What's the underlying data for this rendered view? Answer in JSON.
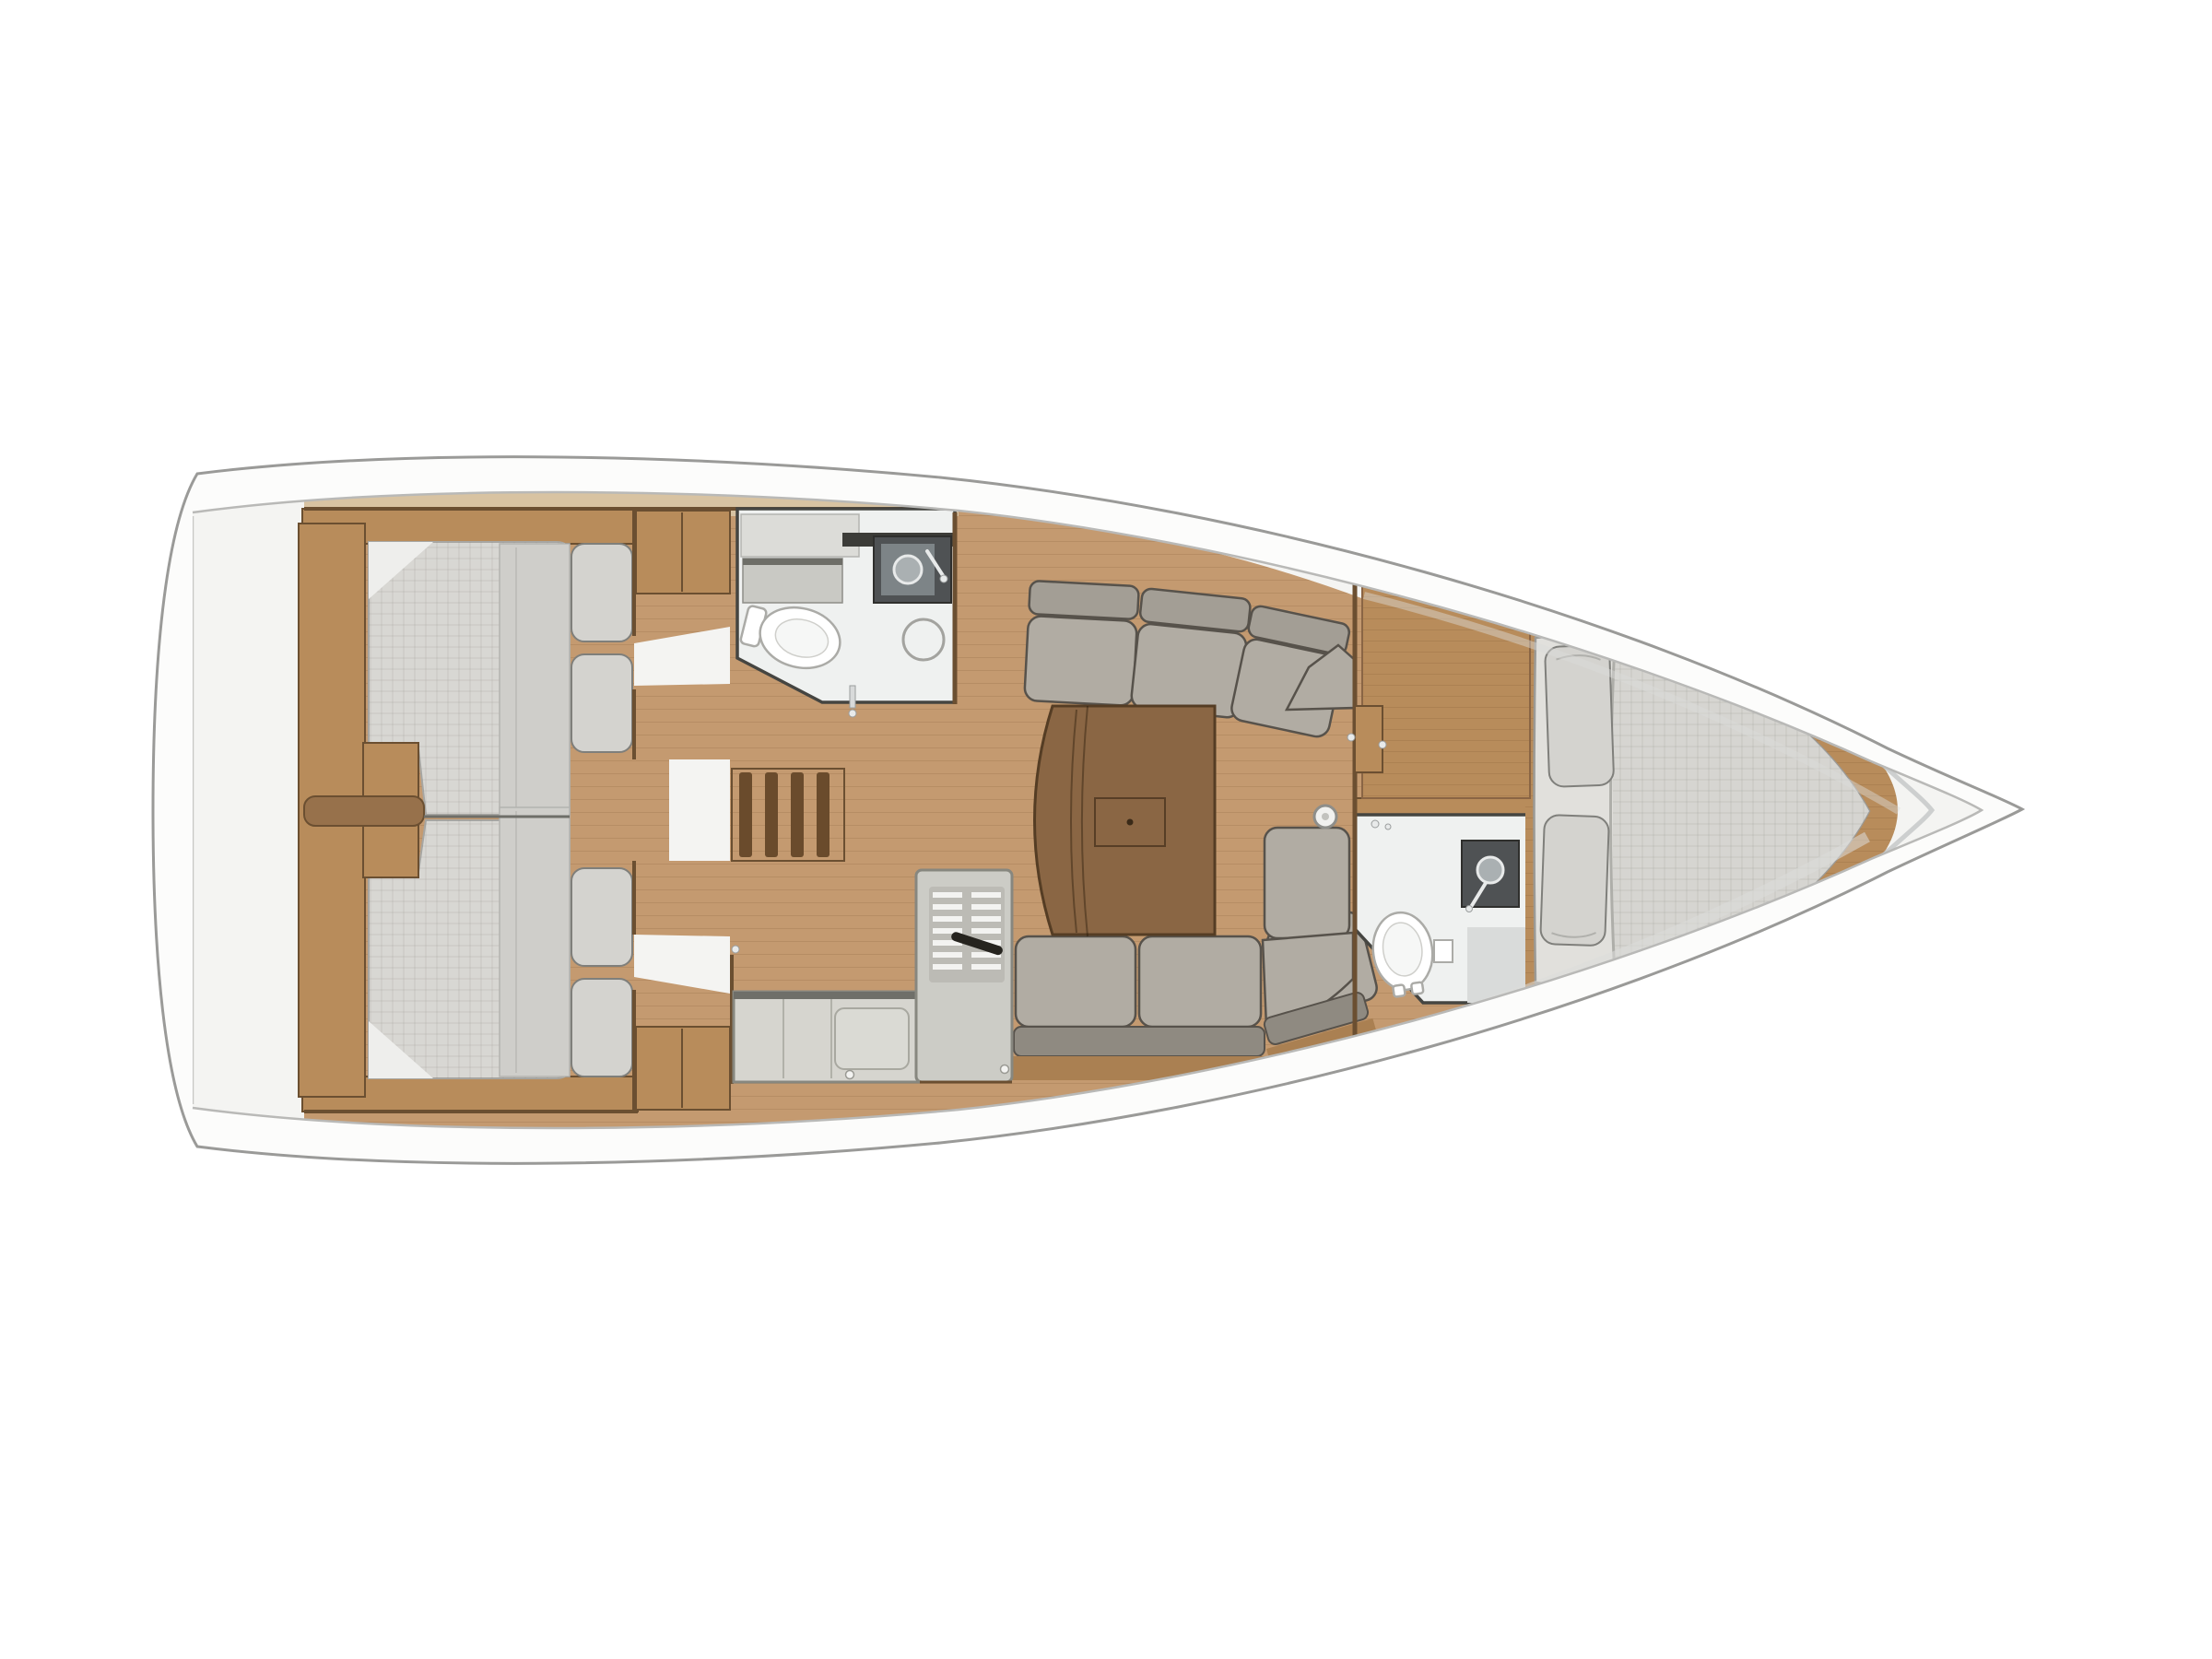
{
  "palette": {
    "page-bg": "#ffffff",
    "hull-fill": "#fcfcfb",
    "hull-stroke": "#9a9a98",
    "deck-line": "#b9b9b7",
    "shadow-line": "#dcdcda",
    "wood-floor": "#c49a70",
    "plank-seam": "rgba(110,74,40,0.16)",
    "wood-deck-band": "#d8c3a2",
    "wood-cabinet": "#b88c5b",
    "wood-cabinet-top": "#d5ae7c",
    "wood-dark": "#6b4f31",
    "wood-divider": "#97714b",
    "wood-rim": "#aa8052",
    "stair-slat": "#6a4b2c",
    "table-fill": "#8a6644",
    "table-stroke": "#553d24",
    "cushion-back": "#a39e95",
    "cushion-seat": "#b1aca3",
    "cushion-stroke": "#57524b",
    "bench-band": "#8f8a81",
    "mattress": "#d8d7d3",
    "mattress-stroke": "#a7a6a2",
    "duvet": "#cfceca",
    "pillow": "#d4d3cf",
    "pillow-stroke": "#7f7f7b",
    "white-area": "#f4f4f2",
    "head-floor": "#eff1f0",
    "head-wall": "#454541",
    "fixture-white": "#ffffff",
    "fixture-stroke": "#ababa7",
    "vanity-dark": "#4f5254",
    "steel": "#7d8487",
    "steel-light": "#aab0b2",
    "chrome": "#e8eaea",
    "galley-counter": "#d6d5cf",
    "galley-unit": "#ccccc6",
    "galley-edge": "#87877f",
    "galley-dark-edge": "#6f6f69",
    "vent-bg": "#bcbbb5",
    "vent-slat": "#f3f3f1",
    "handle-dark": "#26241f",
    "quilt-line": "rgba(120,120,115,0.18)",
    "shower-ring": "#a3a39f",
    "gray-zone": "#d9dbda"
  },
  "legend": {
    "view": "overhead-floor-plan",
    "bow": "right",
    "stern": "left"
  },
  "counts": {
    "cabins": 3,
    "heads": 2,
    "double-berths": 3,
    "settees": 2
  },
  "rooms": [
    {
      "id": "transom-platform",
      "features": []
    },
    {
      "id": "aft-cabin-port",
      "features": [
        "double-berth",
        "two-pillows",
        "wardrobe",
        "cabin-door"
      ]
    },
    {
      "id": "aft-cabin-starboard",
      "features": [
        "double-berth",
        "two-pillows",
        "wardrobe",
        "cabin-door"
      ]
    },
    {
      "id": "companionway",
      "features": [
        "stairs-four-treads",
        "landing"
      ]
    },
    {
      "id": "aft-head-port",
      "features": [
        "toilet",
        "sink-vanity",
        "shower",
        "cabinet",
        "door-handle"
      ]
    },
    {
      "id": "salon",
      "features": [
        "port-settee",
        "starboard-u-settee",
        "folding-table",
        "compression-post"
      ]
    },
    {
      "id": "galley-starboard",
      "features": [
        "l-shaped-counter",
        "refrigerator-vent",
        "sink-cover",
        "knobs"
      ]
    },
    {
      "id": "forward-head-starboard",
      "features": [
        "toilet",
        "sink-vanity",
        "paper-holder",
        "door-handle"
      ]
    },
    {
      "id": "forward-cabin",
      "features": [
        "v-berth-double",
        "two-pillows",
        "vanity-desk",
        "cabin-door"
      ]
    },
    {
      "id": "anchor-locker",
      "features": []
    }
  ]
}
